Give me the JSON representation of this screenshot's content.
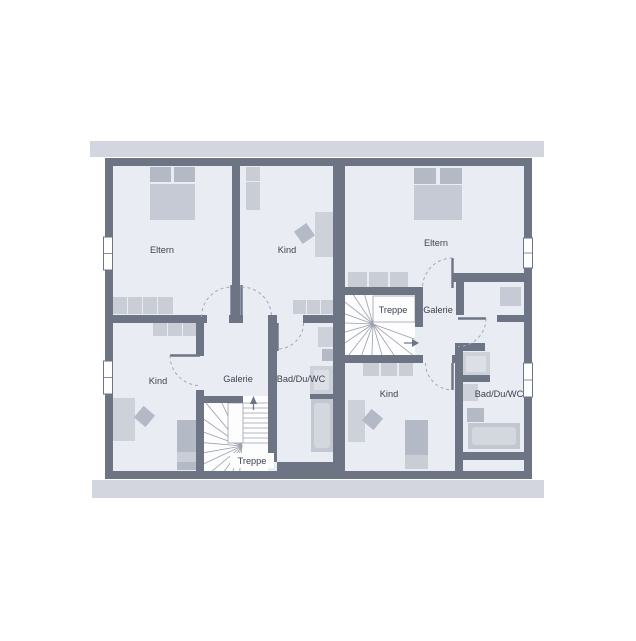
{
  "plan_title": "floor-plan",
  "colors": {
    "page_bg": "#ffffff",
    "wall": "#6d7585",
    "floor": "#e9ecf2",
    "roof_band": "#d3d6de",
    "stair_white": "#fdfdfe",
    "stair_line": "#9aa0ac",
    "arc": "#a2a8b3",
    "text": "#3d4250",
    "furn_dark": "#b3b9c5",
    "furn_light": "#c9cdd6",
    "desk": "#cdd1da",
    "inner": "#dcdfe5",
    "tub": "#c2c7d1",
    "tub_inner": "#d3d7de",
    "bed_body": "#c5cad4"
  },
  "room_labels": [
    {
      "text": "Eltern",
      "x": 162,
      "y": 253
    },
    {
      "text": "Kind",
      "x": 287,
      "y": 253
    },
    {
      "text": "Eltern",
      "x": 436,
      "y": 246
    },
    {
      "text": "Kind",
      "x": 158,
      "y": 384
    },
    {
      "text": "Galerie",
      "x": 238,
      "y": 382
    },
    {
      "text": "Bad/Du/WC",
      "x": 301,
      "y": 382
    },
    {
      "text": "Treppe",
      "x": 252,
      "y": 464,
      "bg": [
        230,
        453,
        44,
        15
      ]
    },
    {
      "text": "Treppe",
      "x": 393,
      "y": 313
    },
    {
      "text": "Galerie",
      "x": 438,
      "y": 313
    },
    {
      "text": "Kind",
      "x": 389,
      "y": 397
    },
    {
      "text": "Bad/Du/WC",
      "x": 499,
      "y": 397
    }
  ],
  "roof_bands": [
    [
      90,
      141,
      454,
      16
    ],
    [
      92,
      480,
      452,
      18
    ]
  ],
  "building": {
    "outer": [
      105,
      158,
      427,
      321
    ],
    "inner": [
      113,
      166,
      411,
      305
    ]
  },
  "walls": [
    [
      105,
      158,
      427,
      8
    ],
    [
      105,
      471,
      427,
      8
    ],
    [
      105,
      166,
      8,
      305
    ],
    [
      524,
      166,
      8,
      305
    ],
    [
      333,
      166,
      12,
      305
    ],
    [
      232,
      166,
      8,
      157
    ],
    [
      113,
      315,
      94,
      8
    ],
    [
      229,
      315,
      14,
      8
    ],
    [
      268,
      315,
      9,
      8
    ],
    [
      303,
      315,
      30,
      8
    ],
    [
      268,
      323,
      9,
      139
    ],
    [
      196,
      323,
      8,
      33
    ],
    [
      196,
      390,
      8,
      81
    ],
    [
      196,
      396,
      47,
      7
    ],
    [
      310,
      394,
      23,
      5
    ],
    [
      277,
      462,
      56,
      9
    ],
    [
      345,
      287,
      78,
      8
    ],
    [
      415,
      287,
      8,
      40
    ],
    [
      345,
      355,
      78,
      8
    ],
    [
      452,
      355,
      11,
      8
    ],
    [
      455,
      343,
      8,
      128
    ],
    [
      453,
      273,
      72,
      9
    ],
    [
      456,
      275,
      8,
      40
    ],
    [
      497,
      315,
      28,
      7
    ],
    [
      457,
      343,
      28,
      8
    ],
    [
      455,
      375,
      35,
      7
    ],
    [
      455,
      452,
      70,
      8
    ]
  ],
  "windows": [
    [
      103.5,
      237,
      9,
      33
    ],
    [
      103.5,
      361,
      9,
      33
    ],
    [
      523.5,
      238,
      9,
      30
    ],
    [
      523.5,
      363,
      9,
      34
    ]
  ],
  "furniture": [
    {
      "r": [
        150,
        167,
        21,
        15
      ],
      "c": "furn_dark"
    },
    {
      "r": [
        174,
        167,
        21,
        15
      ],
      "c": "furn_dark"
    },
    {
      "r": [
        150,
        184,
        45,
        36
      ],
      "c": "bed_body"
    },
    {
      "r": [
        113,
        297,
        14,
        17
      ],
      "c": "furn_light"
    },
    {
      "r": [
        128,
        297,
        14,
        17
      ],
      "c": "furn_light"
    },
    {
      "r": [
        143,
        297,
        14,
        17
      ],
      "c": "furn_light"
    },
    {
      "r": [
        158,
        297,
        15,
        17
      ],
      "c": "furn_light"
    },
    {
      "r": [
        246,
        167,
        14,
        14
      ],
      "c": "furn_light"
    },
    {
      "r": [
        246,
        182,
        14,
        28
      ],
      "c": "furn_light"
    },
    {
      "r": [
        315,
        212,
        18,
        45
      ],
      "c": "desk"
    },
    {
      "r": [
        297,
        226,
        15,
        15
      ],
      "c": "furn_dark",
      "rot": -35
    },
    {
      "r": [
        293,
        300,
        13,
        14
      ],
      "c": "furn_light"
    },
    {
      "r": [
        307,
        300,
        13,
        14
      ],
      "c": "furn_light"
    },
    {
      "r": [
        321,
        300,
        12,
        14
      ],
      "c": "furn_light"
    },
    {
      "r": [
        153,
        323,
        14,
        13
      ],
      "c": "furn_light"
    },
    {
      "r": [
        168,
        323,
        14,
        13
      ],
      "c": "furn_light"
    },
    {
      "r": [
        183,
        323,
        14,
        13
      ],
      "c": "furn_light"
    },
    {
      "r": [
        113,
        398,
        22,
        43
      ],
      "c": "desk"
    },
    {
      "r": [
        137,
        409,
        15,
        15
      ],
      "c": "furn_dark",
      "rot": 40
    },
    {
      "r": [
        177,
        420,
        20,
        32
      ],
      "c": "furn_dark"
    },
    {
      "r": [
        177,
        452,
        20,
        10
      ],
      "c": "furn_light"
    },
    {
      "r": [
        177,
        462,
        20,
        8
      ],
      "c": "furn_dark"
    },
    {
      "r": [
        318,
        327,
        15,
        20
      ],
      "c": "desk"
    },
    {
      "r": [
        322,
        349,
        11,
        12
      ],
      "c": "furn_dark"
    },
    {
      "r": [
        310,
        366,
        23,
        28
      ],
      "c": "desk"
    },
    {
      "r": [
        314,
        370,
        15,
        20
      ],
      "c": "inner"
    },
    {
      "r": [
        311,
        399,
        22,
        53
      ],
      "c": "tub"
    },
    {
      "r": [
        314,
        403,
        16,
        45
      ],
      "c": "tub_inner",
      "round": 3
    },
    {
      "r": [
        414,
        168,
        22,
        16
      ],
      "c": "furn_dark"
    },
    {
      "r": [
        440,
        168,
        22,
        16
      ],
      "c": "furn_dark"
    },
    {
      "r": [
        414,
        185,
        48,
        35
      ],
      "c": "bed_body"
    },
    {
      "r": [
        348,
        272,
        19,
        15
      ],
      "c": "furn_light"
    },
    {
      "r": [
        369,
        272,
        19,
        15
      ],
      "c": "furn_light"
    },
    {
      "r": [
        390,
        272,
        18,
        15
      ],
      "c": "furn_light"
    },
    {
      "r": [
        500,
        287,
        21,
        19
      ],
      "c": "bed_body"
    },
    {
      "r": [
        462,
        352,
        28,
        23
      ],
      "c": "desk"
    },
    {
      "r": [
        466,
        356,
        20,
        16
      ],
      "c": "inner"
    },
    {
      "r": [
        363,
        363,
        16,
        13
      ],
      "c": "furn_light"
    },
    {
      "r": [
        381,
        363,
        16,
        13
      ],
      "c": "furn_light"
    },
    {
      "r": [
        399,
        363,
        14,
        13
      ],
      "c": "furn_light"
    },
    {
      "r": [
        348,
        400,
        17,
        42
      ],
      "c": "desk"
    },
    {
      "r": [
        365,
        412,
        15,
        15
      ],
      "c": "furn_dark",
      "rot": 40
    },
    {
      "r": [
        405,
        420,
        23,
        35
      ],
      "c": "furn_dark"
    },
    {
      "r": [
        405,
        455,
        23,
        14
      ],
      "c": "furn_light"
    },
    {
      "r": [
        463,
        384,
        15,
        17
      ],
      "c": "desk"
    },
    {
      "r": [
        467,
        408,
        17,
        14
      ],
      "c": "furn_dark"
    },
    {
      "r": [
        468,
        423,
        52,
        26
      ],
      "c": "tub"
    },
    {
      "r": [
        472,
        427,
        44,
        18
      ],
      "c": "tub_inner",
      "round": 3
    }
  ],
  "doors": {
    "leaves": [
      [
        231.5,
        285,
        231.5,
        317
      ],
      [
        241.5,
        285,
        241.5,
        317
      ],
      [
        170,
        355.5,
        200,
        355.5
      ],
      [
        277.5,
        323,
        277.5,
        351
      ],
      [
        452.5,
        258,
        452.5,
        288
      ],
      [
        452.5,
        363,
        452.5,
        390
      ],
      [
        458,
        318.5,
        486,
        318.5
      ]
    ],
    "arcs": [
      "M 201.5 317 A 30 30 0 0 1 231.5 287",
      "M 241.5 287 A 30 30 0 0 1 271.5 317",
      "M 170 355.5 A 30 30 0 0 0 200 385.5",
      "M 303.5 323 A 26 26 0 0 1 277.5 349",
      "M 452.5 258 A 30 30 0 0 0 422.5 288",
      "M 425.5 363 A 27 27 0 0 0 452.5 390",
      "M 486 318.5 A 28 28 0 0 1 458 346.5"
    ]
  },
  "stairs": [
    {
      "id": "L",
      "box": [
        204,
        396,
        64,
        75
      ],
      "landing": [
        228,
        403,
        15,
        40
      ],
      "clips": [
        [
          204,
          396,
          24,
          75
        ],
        [
          228,
          443,
          40,
          28
        ]
      ],
      "fan": {
        "cx": 242,
        "cy": 446,
        "len": 58,
        "angles": [
          100,
          115,
          130,
          145,
          160,
          175,
          190,
          205,
          220,
          235,
          250,
          265
        ]
      },
      "treads": {
        "x1": 243,
        "x2": 268,
        "y0": 403,
        "step": 5,
        "count": 9
      },
      "arrow": {
        "points": "250,404 257,404 253.5,396",
        "stem": [
          253.5,
          404,
          253.5,
          410
        ]
      }
    },
    {
      "id": "R",
      "box": [
        345,
        295,
        70,
        60
      ],
      "landing": [
        373,
        296,
        42,
        26
      ],
      "clips": [
        [
          345,
          295,
          28,
          60
        ],
        [
          373,
          322,
          42,
          33
        ]
      ],
      "fan": {
        "cx": 373,
        "cy": 324,
        "len": 62,
        "angles": [
          88,
          106,
          124,
          142,
          160,
          178,
          196,
          214,
          232,
          250,
          268,
          286,
          304,
          322,
          340
        ]
      },
      "treads": null,
      "arrow": {
        "points": "412,339 412,347 419,343",
        "stem": [
          404,
          343,
          412,
          343
        ]
      }
    }
  ]
}
